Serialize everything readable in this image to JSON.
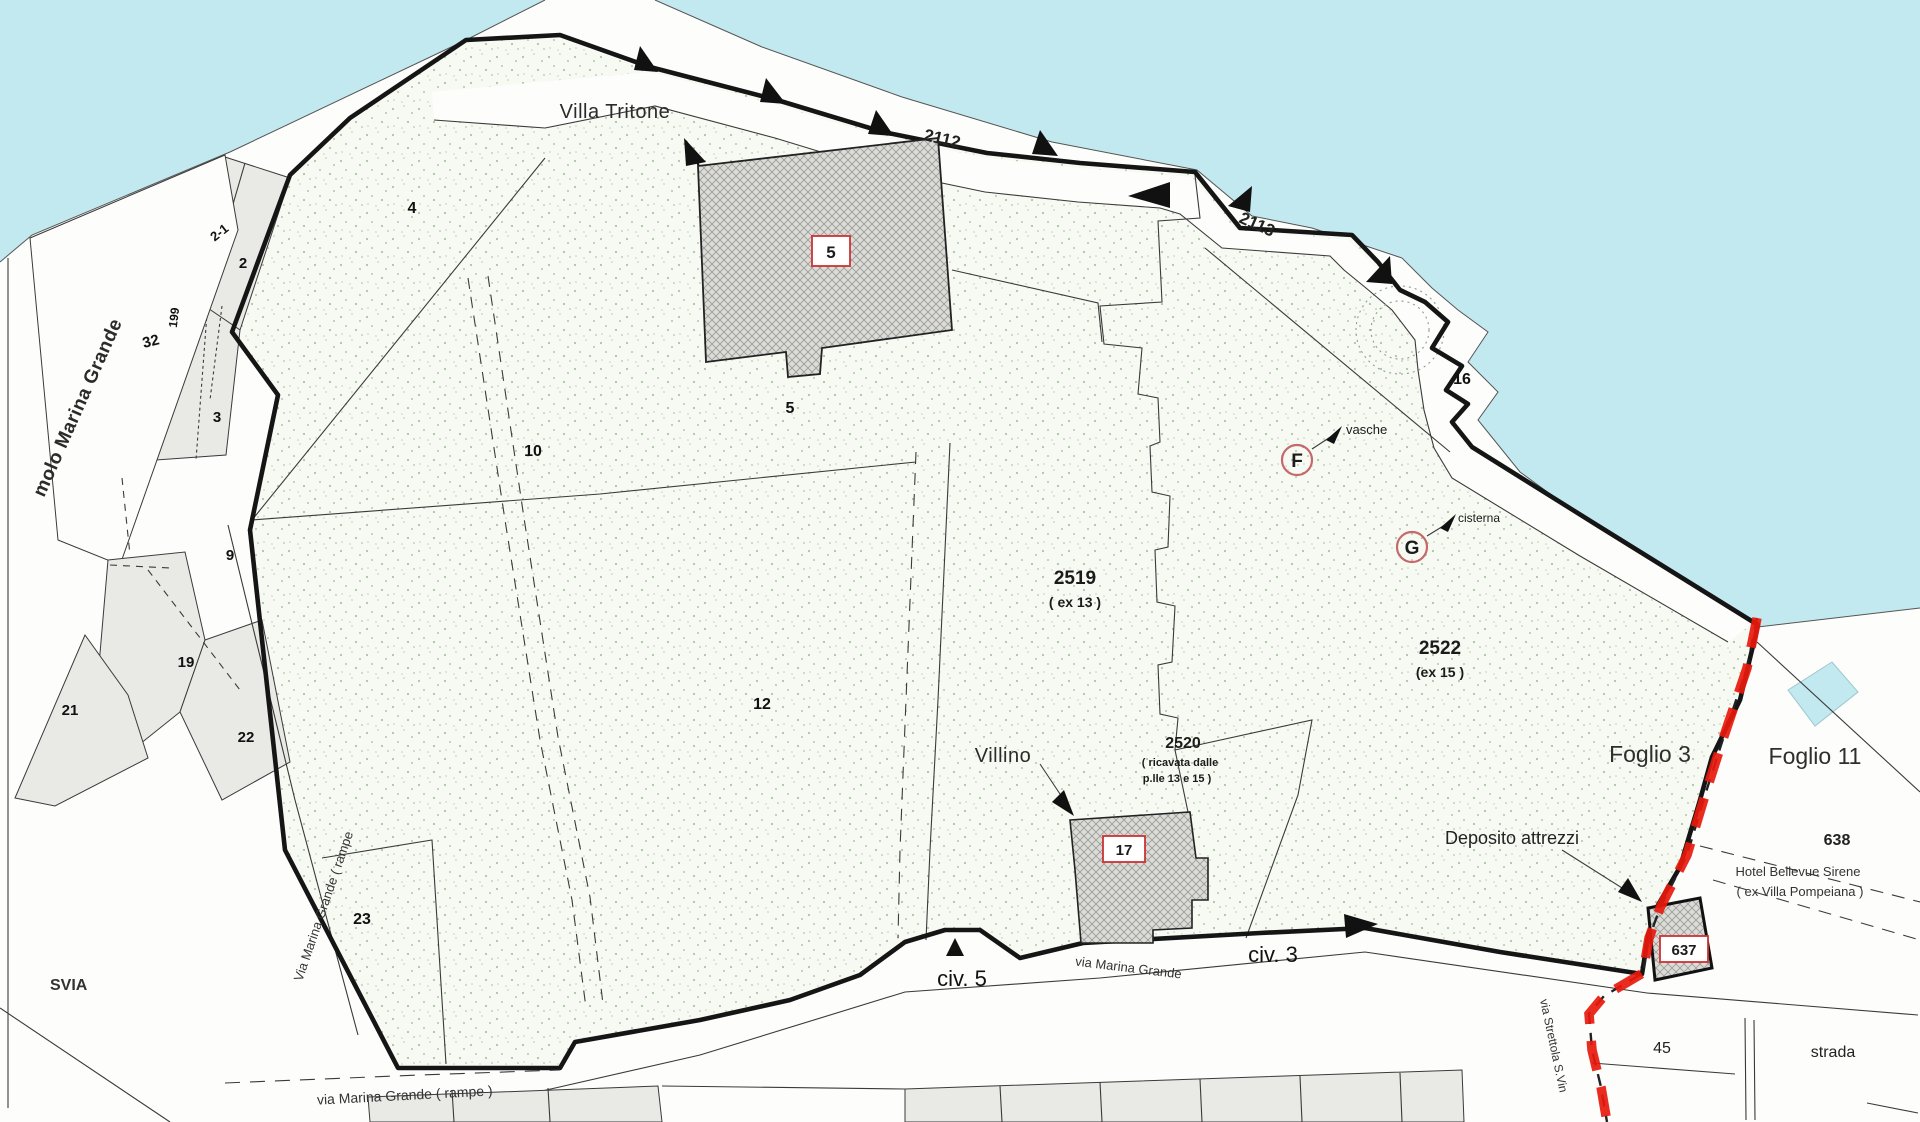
{
  "title": "Cadastral map - Villa Tritone / Marina Grande (Foglio 3 - Foglio 11)",
  "colors": {
    "water": "#c2e9ef",
    "land": "#fdfdfc",
    "estate_fill": "#f6f9f1",
    "stipple_dot": "#abc6a4",
    "gray_parcel": "#e9e9e6",
    "boundary_black": "#151515",
    "foglio_red": "#e8190c",
    "label_box_red": "#cc3333",
    "circle_annotation": "#c46a6a"
  },
  "labels": {
    "villa_tritone": "Villa Tritone",
    "molo": "molo Marina Grande",
    "svia": "SVIA",
    "villino": "Villino",
    "deposito": "Deposito attrezzi",
    "vasche": "vasche",
    "cisterna": "cisterna",
    "letter_f": "F",
    "letter_g": "G",
    "foglio3": "Foglio 3",
    "foglio11": "Foglio 11",
    "hotel_line1": "Hotel Bellevue Sirene",
    "hotel_line2": "( ex Villa Pompeiana )",
    "civ5": "civ. 5",
    "civ3": "civ. 3",
    "via_marina_grande": "via Marina Grande",
    "via_marina_grande_rampe": "via Marina Grande ( rampe )",
    "via_marina_grande_rampe_rot": "Via Marina Grande ( rampe",
    "via_strettola": "via Strettola S.Vin",
    "strada": "strada"
  },
  "coast_numbers": {
    "n2112": "2112",
    "n2113": "2113"
  },
  "parcels": {
    "p2_1": "2-1",
    "p2": "2",
    "p3": "3",
    "p4": "4",
    "p5": "5",
    "p9": "9",
    "p10": "10",
    "p12": "12",
    "p16": "16",
    "p19": "19",
    "p21": "21",
    "p22": "22",
    "p23": "23",
    "p32": "32",
    "p45": "45",
    "p199": "199",
    "p638": "638"
  },
  "parcel_blocks": {
    "p2519": "2519",
    "p2519_sub": "( ex 13 )",
    "p2520": "2520",
    "p2520_sub1": "( ricavata dalle",
    "p2520_sub2": "p.lle 13 e  15 )",
    "p2522": "2522",
    "p2522_sub": "(ex 15 )"
  },
  "buildings": {
    "b5": "5",
    "b17": "17",
    "b637": "637"
  }
}
